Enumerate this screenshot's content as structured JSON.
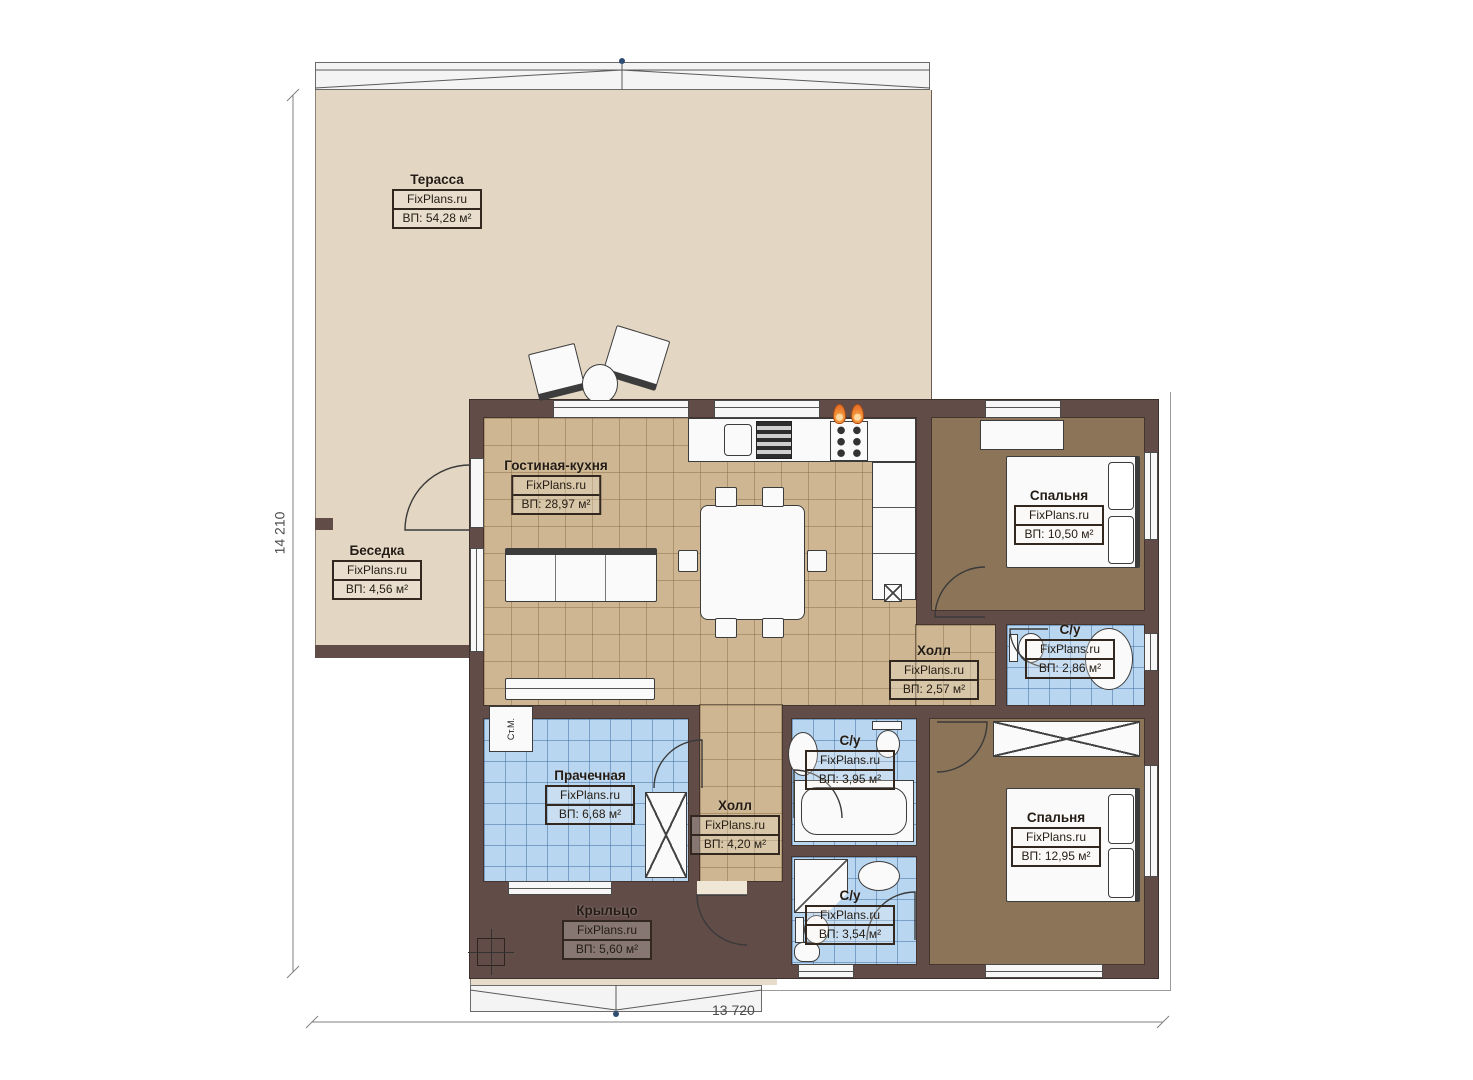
{
  "title": "Floor plan",
  "brand": "FixPlans.ru",
  "dimensions": {
    "height_mm": "14 210",
    "width_mm": "13 720"
  },
  "rooms": [
    {
      "name": "Терасса",
      "brand": "FixPlans.ru",
      "area": "ВП: 54,28 м²"
    },
    {
      "name": "Беседка",
      "brand": "FixPlans.ru",
      "area": "ВП: 4,56 м²"
    },
    {
      "name": "Гостиная-кухня",
      "brand": "FixPlans.ru",
      "area": "ВП: 28,97 м²"
    },
    {
      "name": "Спальня",
      "brand": "FixPlans.ru",
      "area": "ВП: 10,50 м²"
    },
    {
      "name": "Холл",
      "brand": "FixPlans.ru",
      "area": "ВП: 2,57 м²"
    },
    {
      "name": "С/у",
      "brand": "FixPlans.ru",
      "area": "ВП: 2,86 м²"
    },
    {
      "name": "С/у",
      "brand": "FixPlans.ru",
      "area": "ВП: 3,95 м²"
    },
    {
      "name": "Прачечная",
      "brand": "FixPlans.ru",
      "area": "ВП: 6,68 м²"
    },
    {
      "name": "Холл",
      "brand": "FixPlans.ru",
      "area": "ВП: 4,20 м²"
    },
    {
      "name": "С/у",
      "brand": "FixPlans.ru",
      "area": "ВП: 3,54 м²"
    },
    {
      "name": "Спальня",
      "brand": "FixPlans.ru",
      "area": "ВП: 12,95 м²"
    },
    {
      "name": "Крыльцо",
      "brand": "FixPlans.ru",
      "area": "ВП: 5,60 м²"
    }
  ],
  "labels": {
    "washer": "Ст.М."
  },
  "colors": {
    "wall": "#614c48",
    "terrace": "#e3d6c2",
    "floor_tan": "#cdb691",
    "floor_brown": "#8b7457",
    "tile_blue": "#b9d6f0",
    "flame": "#e8742a"
  }
}
